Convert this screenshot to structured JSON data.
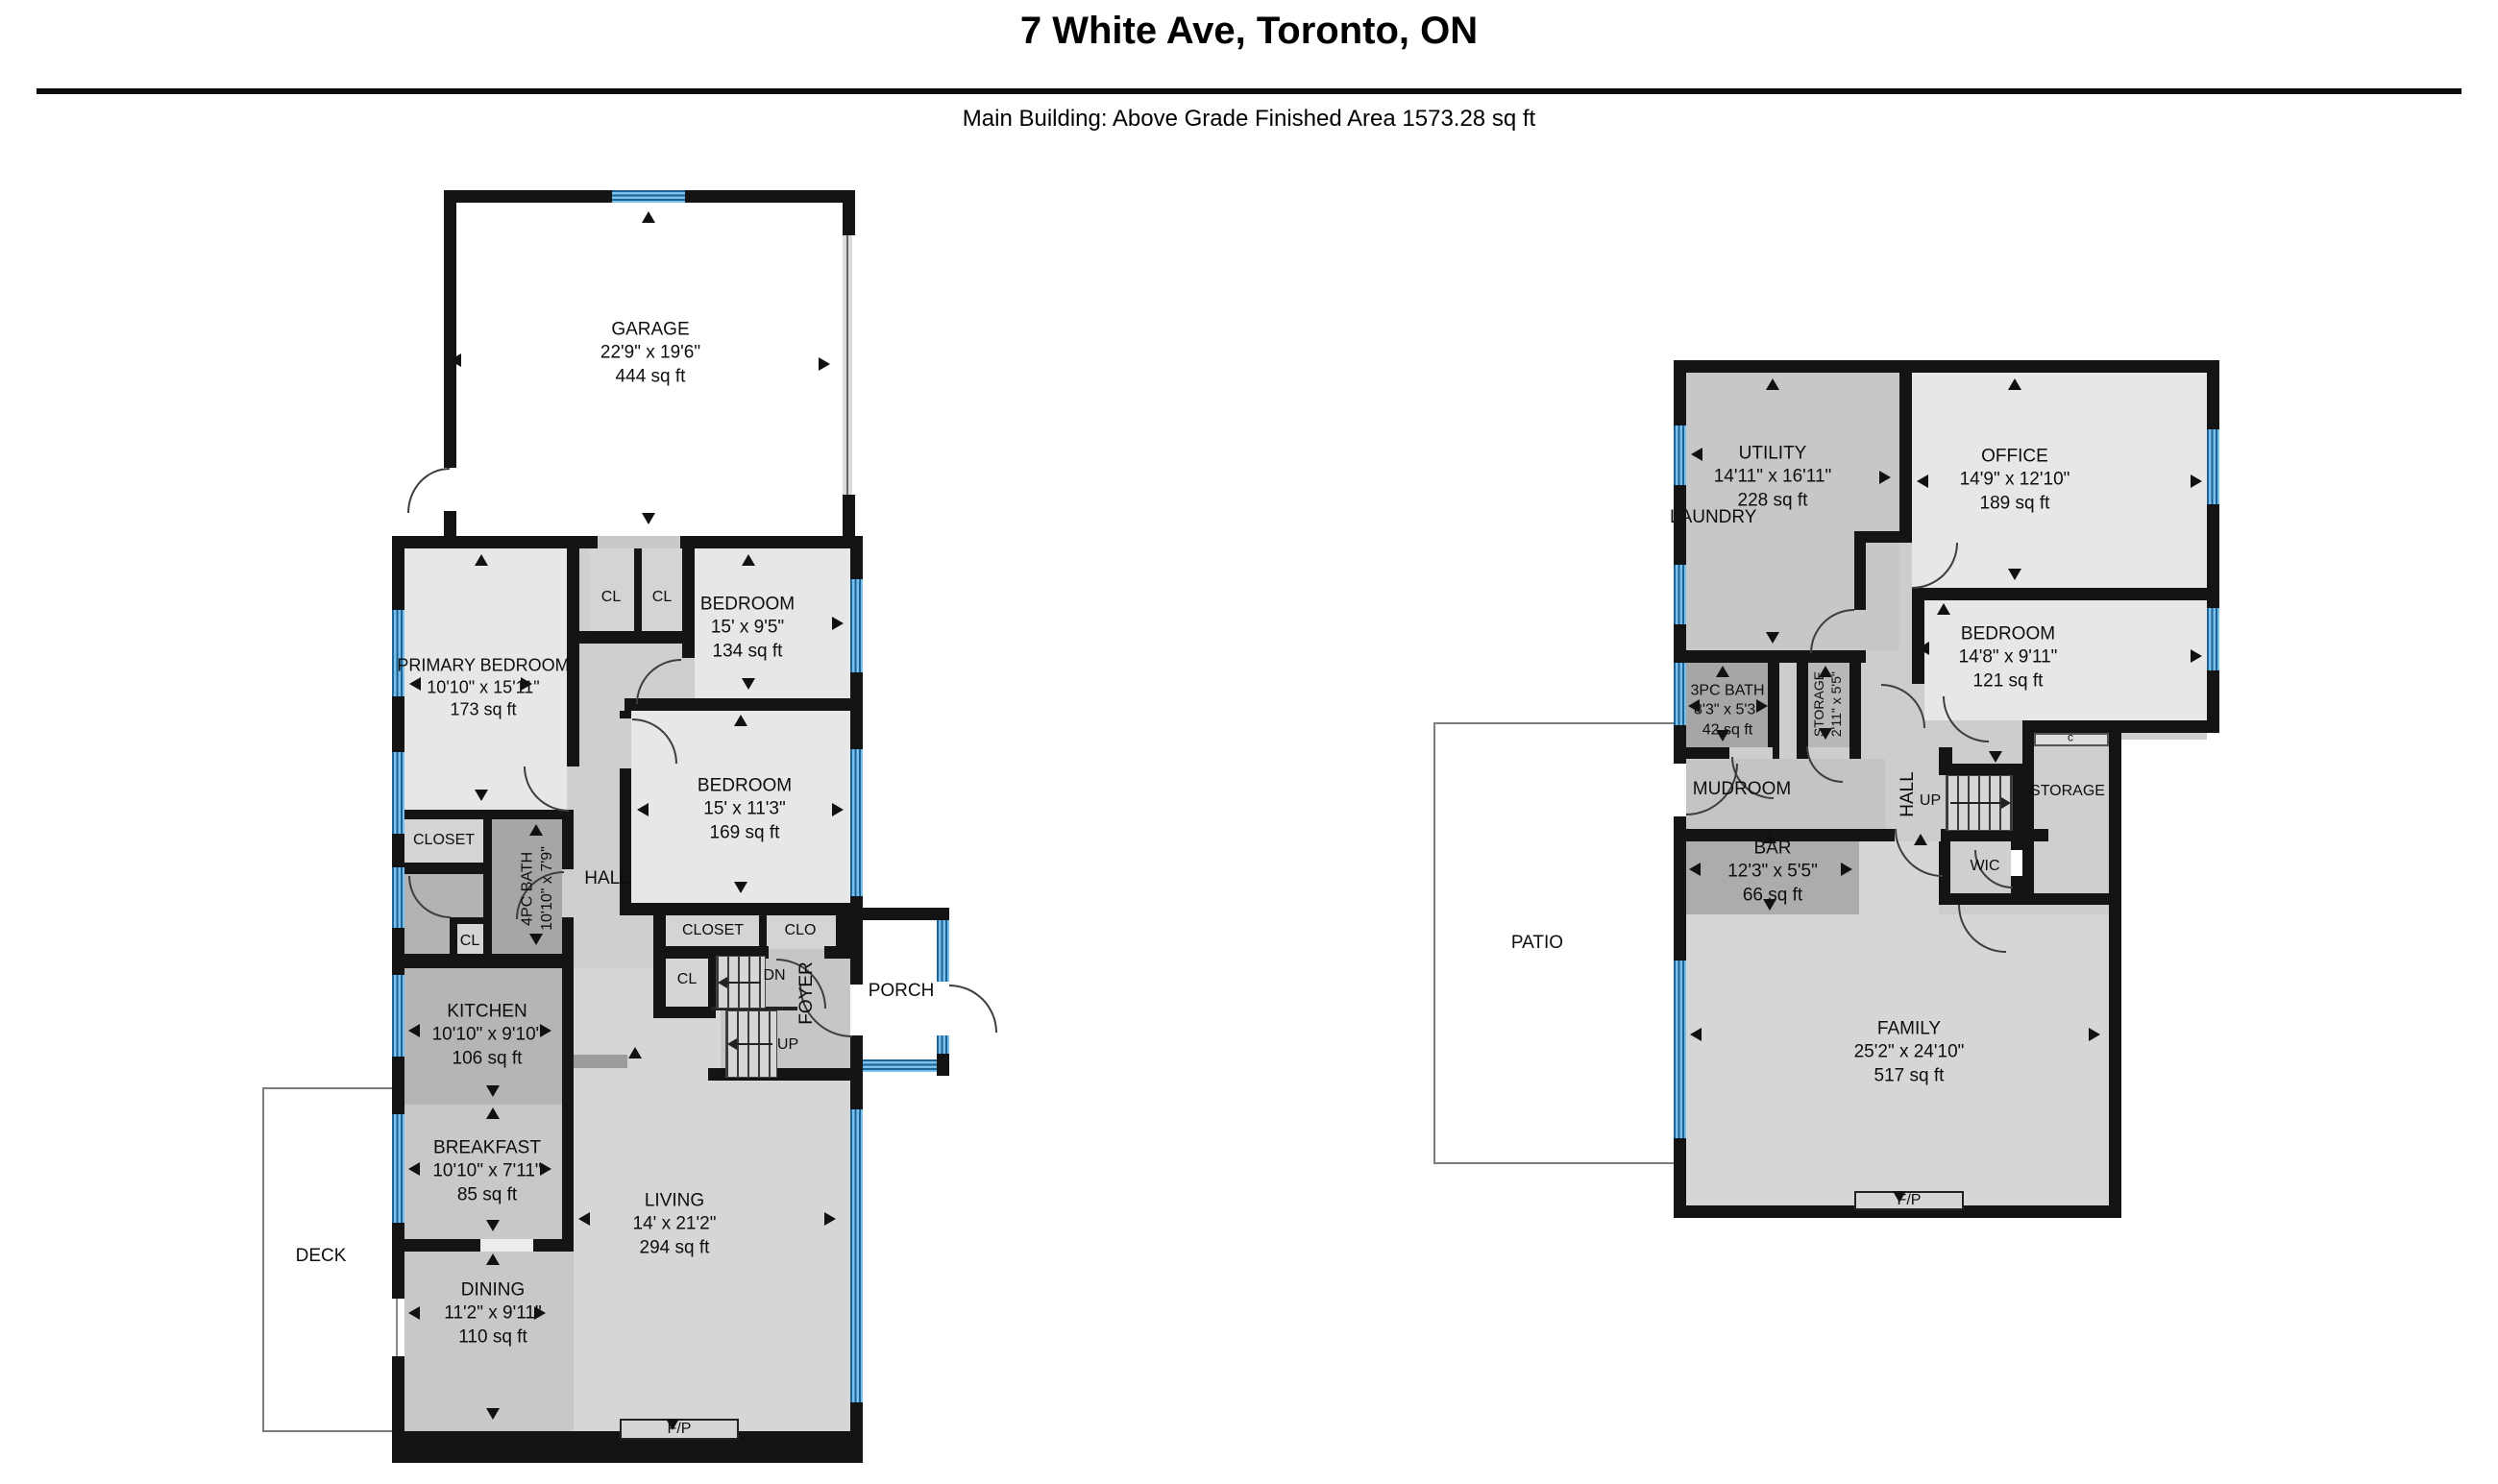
{
  "header": {
    "title": "7 White Ave, Toronto, ON",
    "subtitle": "Main Building: Above Grade Finished Area 1573.28 sq ft"
  },
  "colors": {
    "wall": "#141414",
    "window_blue": "#79c0ea",
    "window_line": "#1d6295",
    "room_light": "#e7e7e7",
    "room_medium": "#c6c6c6",
    "room_dark": "#a6a6a6"
  },
  "floor1": {
    "garage": {
      "name": "GARAGE",
      "dims": "22'9\" x 19'6\"",
      "area": "444 sq ft"
    },
    "primary_bedroom": {
      "name": "PRIMARY BEDROOM",
      "dims": "10'10\" x 15'11\"",
      "area": "173 sq ft"
    },
    "closet_small_1": {
      "name": "CL"
    },
    "closet_small_2": {
      "name": "CL"
    },
    "bedroom_1": {
      "name": "BEDROOM",
      "dims": "15' x 9'5\"",
      "area": "134 sq ft"
    },
    "bedroom_2": {
      "name": "BEDROOM",
      "dims": "15' x 11'3\"",
      "area": "169 sq ft"
    },
    "closet": {
      "name": "CLOSET"
    },
    "bath_4pc": {
      "name": "4PC BATH",
      "dims": "10'10\" x 7'9\""
    },
    "hall": {
      "name": "HALL"
    },
    "closet_small_3": {
      "name": "CL"
    },
    "closet_2": {
      "name": "CLOSET"
    },
    "closet_3": {
      "name": "CLO"
    },
    "closet_small_4": {
      "name": "CL"
    },
    "stairs_down": {
      "name": "DN"
    },
    "stairs_up": {
      "name": "UP"
    },
    "foyer": {
      "name": "FOYER"
    },
    "porch": {
      "name": "PORCH"
    },
    "kitchen": {
      "name": "KITCHEN",
      "dims": "10'10\" x 9'10\"",
      "area": "106 sq ft"
    },
    "breakfast": {
      "name": "BREAKFAST",
      "dims": "10'10\" x 7'11\"",
      "area": "85 sq ft"
    },
    "dining": {
      "name": "DINING",
      "dims": "11'2\" x 9'11\"",
      "area": "110 sq ft"
    },
    "living": {
      "name": "LIVING",
      "dims": "14' x 21'2\"",
      "area": "294 sq ft"
    },
    "deck": {
      "name": "DECK"
    },
    "fireplace": {
      "name": "F/P"
    }
  },
  "floor2": {
    "utility": {
      "name": "UTILITY",
      "dims": "14'11\" x 16'11\"",
      "area": "228 sq ft"
    },
    "laundry": {
      "name": "LAUNDRY"
    },
    "office": {
      "name": "OFFICE",
      "dims": "14'9\" x 12'10\"",
      "area": "189 sq ft"
    },
    "bedroom": {
      "name": "BEDROOM",
      "dims": "14'8\" x 9'11\"",
      "area": "121 sq ft"
    },
    "bath_3pc": {
      "name": "3PC BATH",
      "dims": "8'3\" x 5'3\"",
      "area": "42 sq ft"
    },
    "storage_small": {
      "name": "STORAGE",
      "dims": "2'11\" x 5'5\""
    },
    "mudroom": {
      "name": "MUDROOM"
    },
    "hall": {
      "name": "HALL"
    },
    "stairs_up": {
      "name": "UP"
    },
    "storage": {
      "name": "STORAGE"
    },
    "wic": {
      "name": "WIC"
    },
    "closet_c": {
      "name": "c"
    },
    "bar": {
      "name": "BAR",
      "dims": "12'3\" x 5'5\"",
      "area": "66 sq ft"
    },
    "family": {
      "name": "FAMILY",
      "dims": "25'2\" x 24'10\"",
      "area": "517 sq ft"
    },
    "patio": {
      "name": "PATIO"
    },
    "fireplace": {
      "name": "F/P"
    }
  }
}
